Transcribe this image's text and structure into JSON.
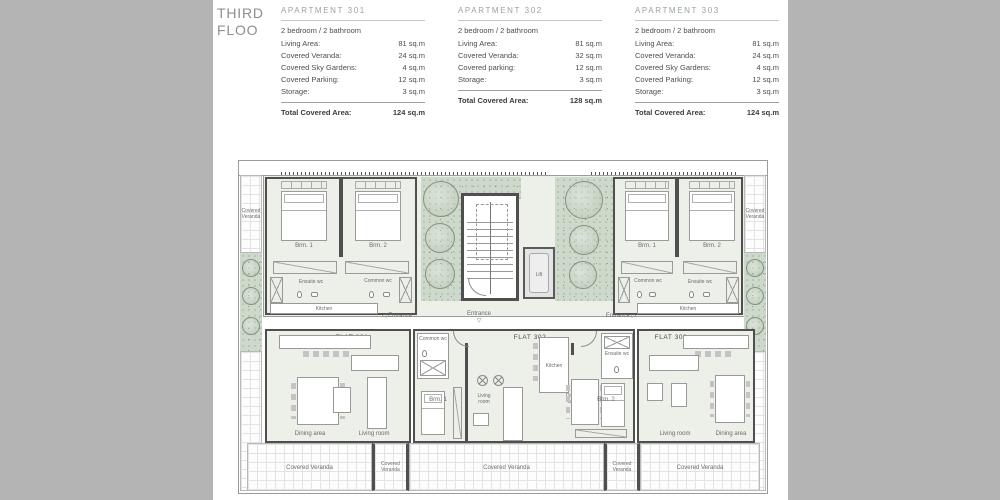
{
  "page": {
    "title_line1": "THIRD",
    "title_line2": "FLOO"
  },
  "apartments": [
    {
      "id": "301",
      "name": "APARTMENT 301",
      "subtitle": "2 bedroom / 2 bathroom",
      "rows": [
        [
          "Living Area:",
          "81 sq.m"
        ],
        [
          "Covered Veranda:",
          "24 sq.m"
        ],
        [
          "Covered Sky Gardens:",
          "4 sq.m"
        ],
        [
          "Covered Parking:",
          "12 sq.m"
        ],
        [
          "Storage:",
          "3 sq.m"
        ]
      ],
      "total_label": "Total Covered Area:",
      "total_value": "124 sq.m"
    },
    {
      "id": "302",
      "name": "APARTMENT 302",
      "subtitle": "2 bedroom / 2 bathroom",
      "rows": [
        [
          "Living Area:",
          "81 sq.m"
        ],
        [
          "Covered Veranda:",
          "32 sq.m"
        ],
        [
          "Covered parking:",
          "12 sq.m"
        ],
        [
          "Storage:",
          "3 sq.m"
        ]
      ],
      "total_label": "Total Covered Area:",
      "total_value": "128 sq.m"
    },
    {
      "id": "303",
      "name": "APARTMENT 303",
      "subtitle": "2 bedroom / 2 bathroom",
      "rows": [
        [
          "Living Area:",
          "81 sq.m"
        ],
        [
          "Covered Veranda:",
          "24 sq.m"
        ],
        [
          "Covered Sky Gardens:",
          "4 sq.m"
        ],
        [
          "Covered Parking:",
          "12 sq.m"
        ],
        [
          "Storage:",
          "3 sq.m"
        ]
      ],
      "total_label": "Total Covered Area:",
      "total_value": "124 sq.m"
    }
  ],
  "plan": {
    "flats": {
      "f301": "FLAT 301",
      "f302": "FLAT 302",
      "f303": "FLAT 303"
    },
    "labels": {
      "brm1": "Brm. 1",
      "brm2": "Brm. 2",
      "ensuite_wc": "Ensuite wc",
      "common_wc": "Common wc",
      "kitchen": "Kitchen",
      "living_room": "Living room",
      "dining_area": "Dining area",
      "entrance": "Entrance",
      "lift": "Lift",
      "covered_veranda": "Covered Veranda",
      "covered": "Covered",
      "veranda": "Veranda",
      "arrow_left": "◁",
      "arrow_right": "▷",
      "arrow_down": "▽"
    },
    "colors": {
      "background": "#b4b4b4",
      "page": "#ffffff",
      "wall": "#4f4f4f",
      "floor": "#edefe9",
      "garden_green": "#cdd9cb",
      "text": "#6b6b6b"
    }
  }
}
